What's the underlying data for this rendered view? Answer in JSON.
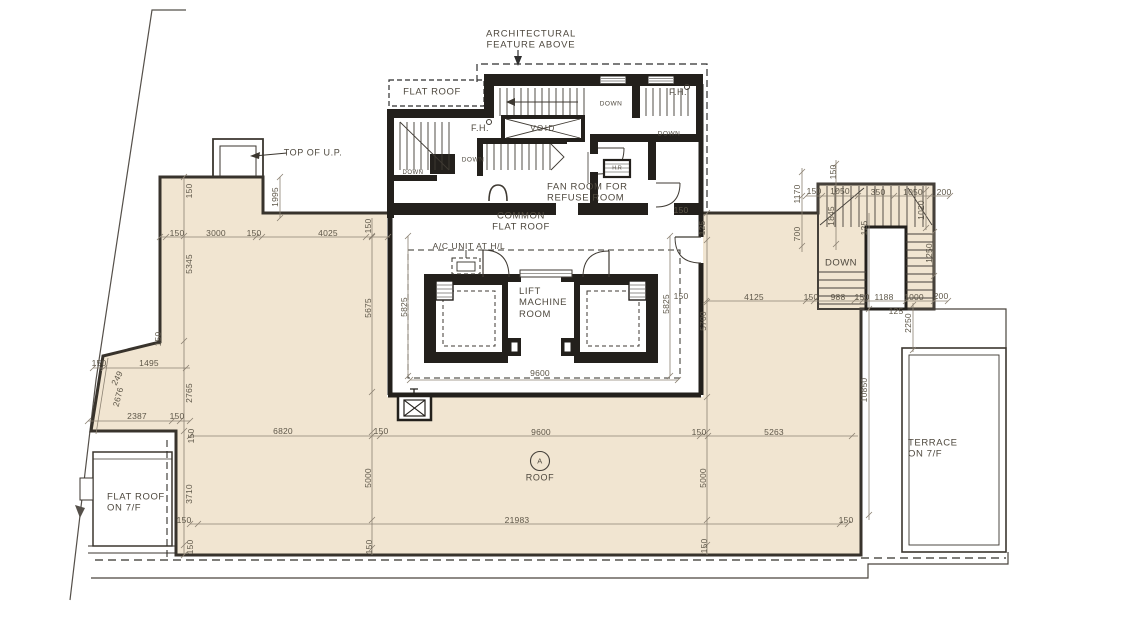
{
  "title": "Roof floor plan",
  "colors": {
    "roof_fill": "#f1e5d1",
    "wall_dark": "#23201c",
    "dim_line": "#8b8172",
    "text": "#4e483e"
  },
  "rooms": {
    "arch_feature_1": "ARCHITECTURAL",
    "arch_feature_2": "FEATURE ABOVE",
    "flat_roof": "FLAT ROOF",
    "top_of_up": "TOP OF U.P.",
    "fan_room_1": "FAN ROOM FOR",
    "fan_room_2": "REFUSE ROOM",
    "common_1": "COMMON",
    "common_2": "FLAT ROOF",
    "ac_unit": "A/C UNIT AT H/L",
    "lift_1": "LIFT",
    "lift_2": "MACHINE",
    "lift_3": "ROOM",
    "void": "VOID",
    "terrace_1": "TERRACE",
    "terrace_2": "ON 7/F",
    "flat_roof_7f_1": "FLAT ROOF",
    "flat_roof_7f_2": "ON 7/F",
    "roof_marker": "A",
    "roof": "ROOF",
    "hose_reel": "H.R"
  },
  "annotations": [
    {
      "t": "DOWN",
      "name": "down-label",
      "x": 413,
      "y": 173,
      "fs": 6
    },
    {
      "t": "DOWN",
      "name": "down-label",
      "x": 473,
      "y": 160,
      "fs": 6.5
    },
    {
      "t": "DOWN",
      "name": "down-label",
      "x": 611,
      "y": 104,
      "fs": 6.5
    },
    {
      "t": "DOWN",
      "name": "down-label",
      "x": 669,
      "y": 134,
      "fs": 6.5
    },
    {
      "t": "DOWN",
      "name": "down-label",
      "x": 841,
      "y": 263,
      "fs": 9.5
    },
    {
      "t": "F.H.",
      "name": "fire-hydrant-label",
      "x": 480,
      "y": 128,
      "fs": 9
    },
    {
      "t": "F.H.",
      "name": "fire-hydrant-label",
      "x": 678,
      "y": 92,
      "fs": 9
    }
  ],
  "dimensions": [
    {
      "t": "150",
      "x": 177,
      "y": 233
    },
    {
      "t": "3000",
      "x": 216,
      "y": 233
    },
    {
      "t": "150",
      "x": 254,
      "y": 233
    },
    {
      "t": "4025",
      "x": 328,
      "y": 233
    },
    {
      "t": "150",
      "x": 368,
      "y": 226,
      "r": -90
    },
    {
      "t": "150",
      "x": 189,
      "y": 191,
      "r": -90
    },
    {
      "t": "1995",
      "x": 275,
      "y": 197,
      "r": -90
    },
    {
      "t": "5345",
      "x": 189,
      "y": 264,
      "r": -90
    },
    {
      "t": "150",
      "x": 158,
      "y": 339,
      "r": -90
    },
    {
      "t": "5675",
      "x": 368,
      "y": 308,
      "r": -90
    },
    {
      "t": "5825",
      "x": 404,
      "y": 307,
      "r": -90
    },
    {
      "t": "5825",
      "x": 666,
      "y": 304,
      "r": -90
    },
    {
      "t": "150",
      "x": 681,
      "y": 210
    },
    {
      "t": "125",
      "x": 702,
      "y": 228,
      "r": -90
    },
    {
      "t": "150",
      "x": 681,
      "y": 296
    },
    {
      "t": "5700",
      "x": 703,
      "y": 321,
      "r": -90
    },
    {
      "t": "4125",
      "x": 754,
      "y": 297
    },
    {
      "t": "150",
      "x": 811,
      "y": 297
    },
    {
      "t": "988",
      "x": 838,
      "y": 297
    },
    {
      "t": "150",
      "x": 862,
      "y": 297
    },
    {
      "t": "1188",
      "x": 884,
      "y": 297
    },
    {
      "t": "125",
      "x": 896,
      "y": 311
    },
    {
      "t": "1000",
      "x": 914,
      "y": 297
    },
    {
      "t": "200",
      "x": 941,
      "y": 296
    },
    {
      "t": "2250",
      "x": 908,
      "y": 323,
      "r": -90
    },
    {
      "t": "10850",
      "x": 864,
      "y": 390,
      "r": -90
    },
    {
      "t": "150",
      "x": 833,
      "y": 172,
      "r": -90
    },
    {
      "t": "1170",
      "x": 797,
      "y": 194,
      "r": -90
    },
    {
      "t": "150",
      "x": 814,
      "y": 191
    },
    {
      "t": "1050",
      "x": 840,
      "y": 191
    },
    {
      "t": "350",
      "x": 878,
      "y": 192
    },
    {
      "t": "1050",
      "x": 913,
      "y": 192
    },
    {
      "t": "200",
      "x": 944,
      "y": 192
    },
    {
      "t": "1845",
      "x": 831,
      "y": 216,
      "r": -90
    },
    {
      "t": "1020",
      "x": 921,
      "y": 210,
      "r": -90
    },
    {
      "t": "700",
      "x": 797,
      "y": 234,
      "r": -90
    },
    {
      "t": "125",
      "x": 864,
      "y": 228,
      "r": -90
    },
    {
      "t": "1250",
      "x": 929,
      "y": 253,
      "r": -90
    },
    {
      "t": "9600",
      "x": 540,
      "y": 373
    },
    {
      "t": "150",
      "x": 99,
      "y": 363
    },
    {
      "t": "1495",
      "x": 149,
      "y": 363
    },
    {
      "t": "249",
      "x": 117,
      "y": 378,
      "r": -62
    },
    {
      "t": "2676",
      "x": 118,
      "y": 397,
      "r": -75
    },
    {
      "t": "2765",
      "x": 189,
      "y": 393,
      "r": -90
    },
    {
      "t": "2387",
      "x": 137,
      "y": 416
    },
    {
      "t": "150",
      "x": 177,
      "y": 416
    },
    {
      "t": "150",
      "x": 191,
      "y": 436,
      "r": -90
    },
    {
      "t": "6820",
      "x": 283,
      "y": 431
    },
    {
      "t": "150",
      "x": 381,
      "y": 431
    },
    {
      "t": "9600",
      "x": 541,
      "y": 432
    },
    {
      "t": "150",
      "x": 699,
      "y": 432
    },
    {
      "t": "5263",
      "x": 774,
      "y": 432
    },
    {
      "t": "5000",
      "x": 368,
      "y": 478,
      "r": -90
    },
    {
      "t": "5000",
      "x": 703,
      "y": 478,
      "r": -90
    },
    {
      "t": "3710",
      "x": 189,
      "y": 494,
      "r": -90
    },
    {
      "t": "21983",
      "x": 517,
      "y": 520
    },
    {
      "t": "150",
      "x": 184,
      "y": 520
    },
    {
      "t": "150",
      "x": 846,
      "y": 520
    },
    {
      "t": "150",
      "x": 190,
      "y": 547,
      "r": -90
    },
    {
      "t": "150",
      "x": 369,
      "y": 547,
      "r": -90
    },
    {
      "t": "150",
      "x": 704,
      "y": 546,
      "r": -90
    }
  ]
}
